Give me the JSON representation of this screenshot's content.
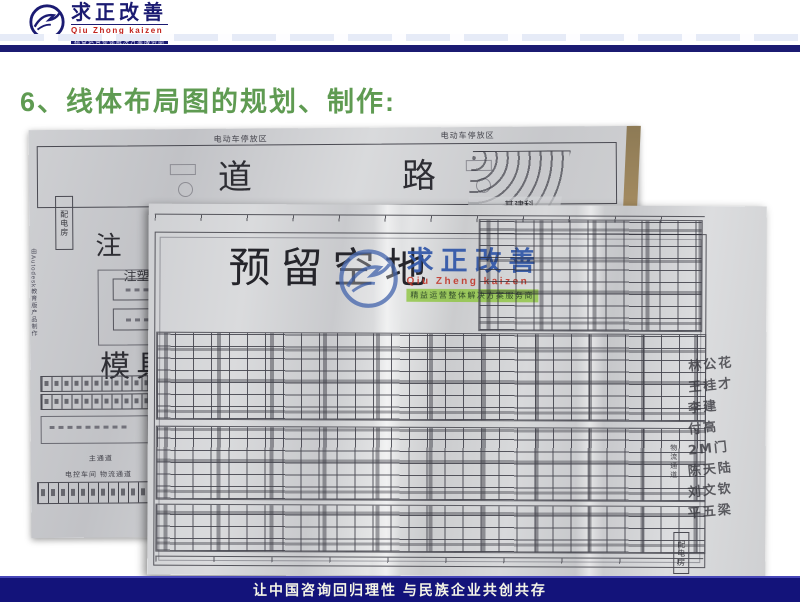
{
  "header": {
    "brand_cn": "求正改善",
    "brand_pinyin": "Qiu Zhong kaizen",
    "brand_tagline": "精益运营整体解决方案服务商"
  },
  "title": "6、线体布局图的规划、制作:",
  "photo": {
    "base": {
      "parking_label_left": "电动车停放区",
      "parking_label_right": "电动车停放区",
      "road_label": "道路",
      "power_room": "配电房",
      "autodesk_note": "由Autodesk教育版产品制作",
      "note_char": "注",
      "injection_label": "注塑",
      "mold_room": "模具房",
      "infra_label": "基建科",
      "main_aisle": "主通道",
      "workshop_row": "电控车间  物流通道"
    },
    "overlay": {
      "reserved_label": "预留空地",
      "watermark": {
        "brand_cn": "求正改善",
        "brand_pinyin": "Qiu Zheng kaizen",
        "brand_tagline": "精益运营整体解决方案服务商"
      },
      "handwriting": [
        "林公花",
        "王桂才",
        "李建",
        "付高",
        "2M门",
        "陈天陆",
        "刘文钦",
        "平五梁"
      ],
      "logistics_label": "物流通道",
      "power_room": "配电房"
    }
  },
  "footer": {
    "slogan": "让中国咨询回归理性  与民族企业共创共存"
  },
  "colors": {
    "navy": "#1b1b72",
    "brand_red": "#c2231d",
    "title_green": "#5f9b52",
    "watermark_blue": "#3056a8",
    "watermark_green": "#8cc43c",
    "footer_navy": "#13137a",
    "table_brown": "#97815c",
    "paper_gray": "#cfd0d3"
  }
}
